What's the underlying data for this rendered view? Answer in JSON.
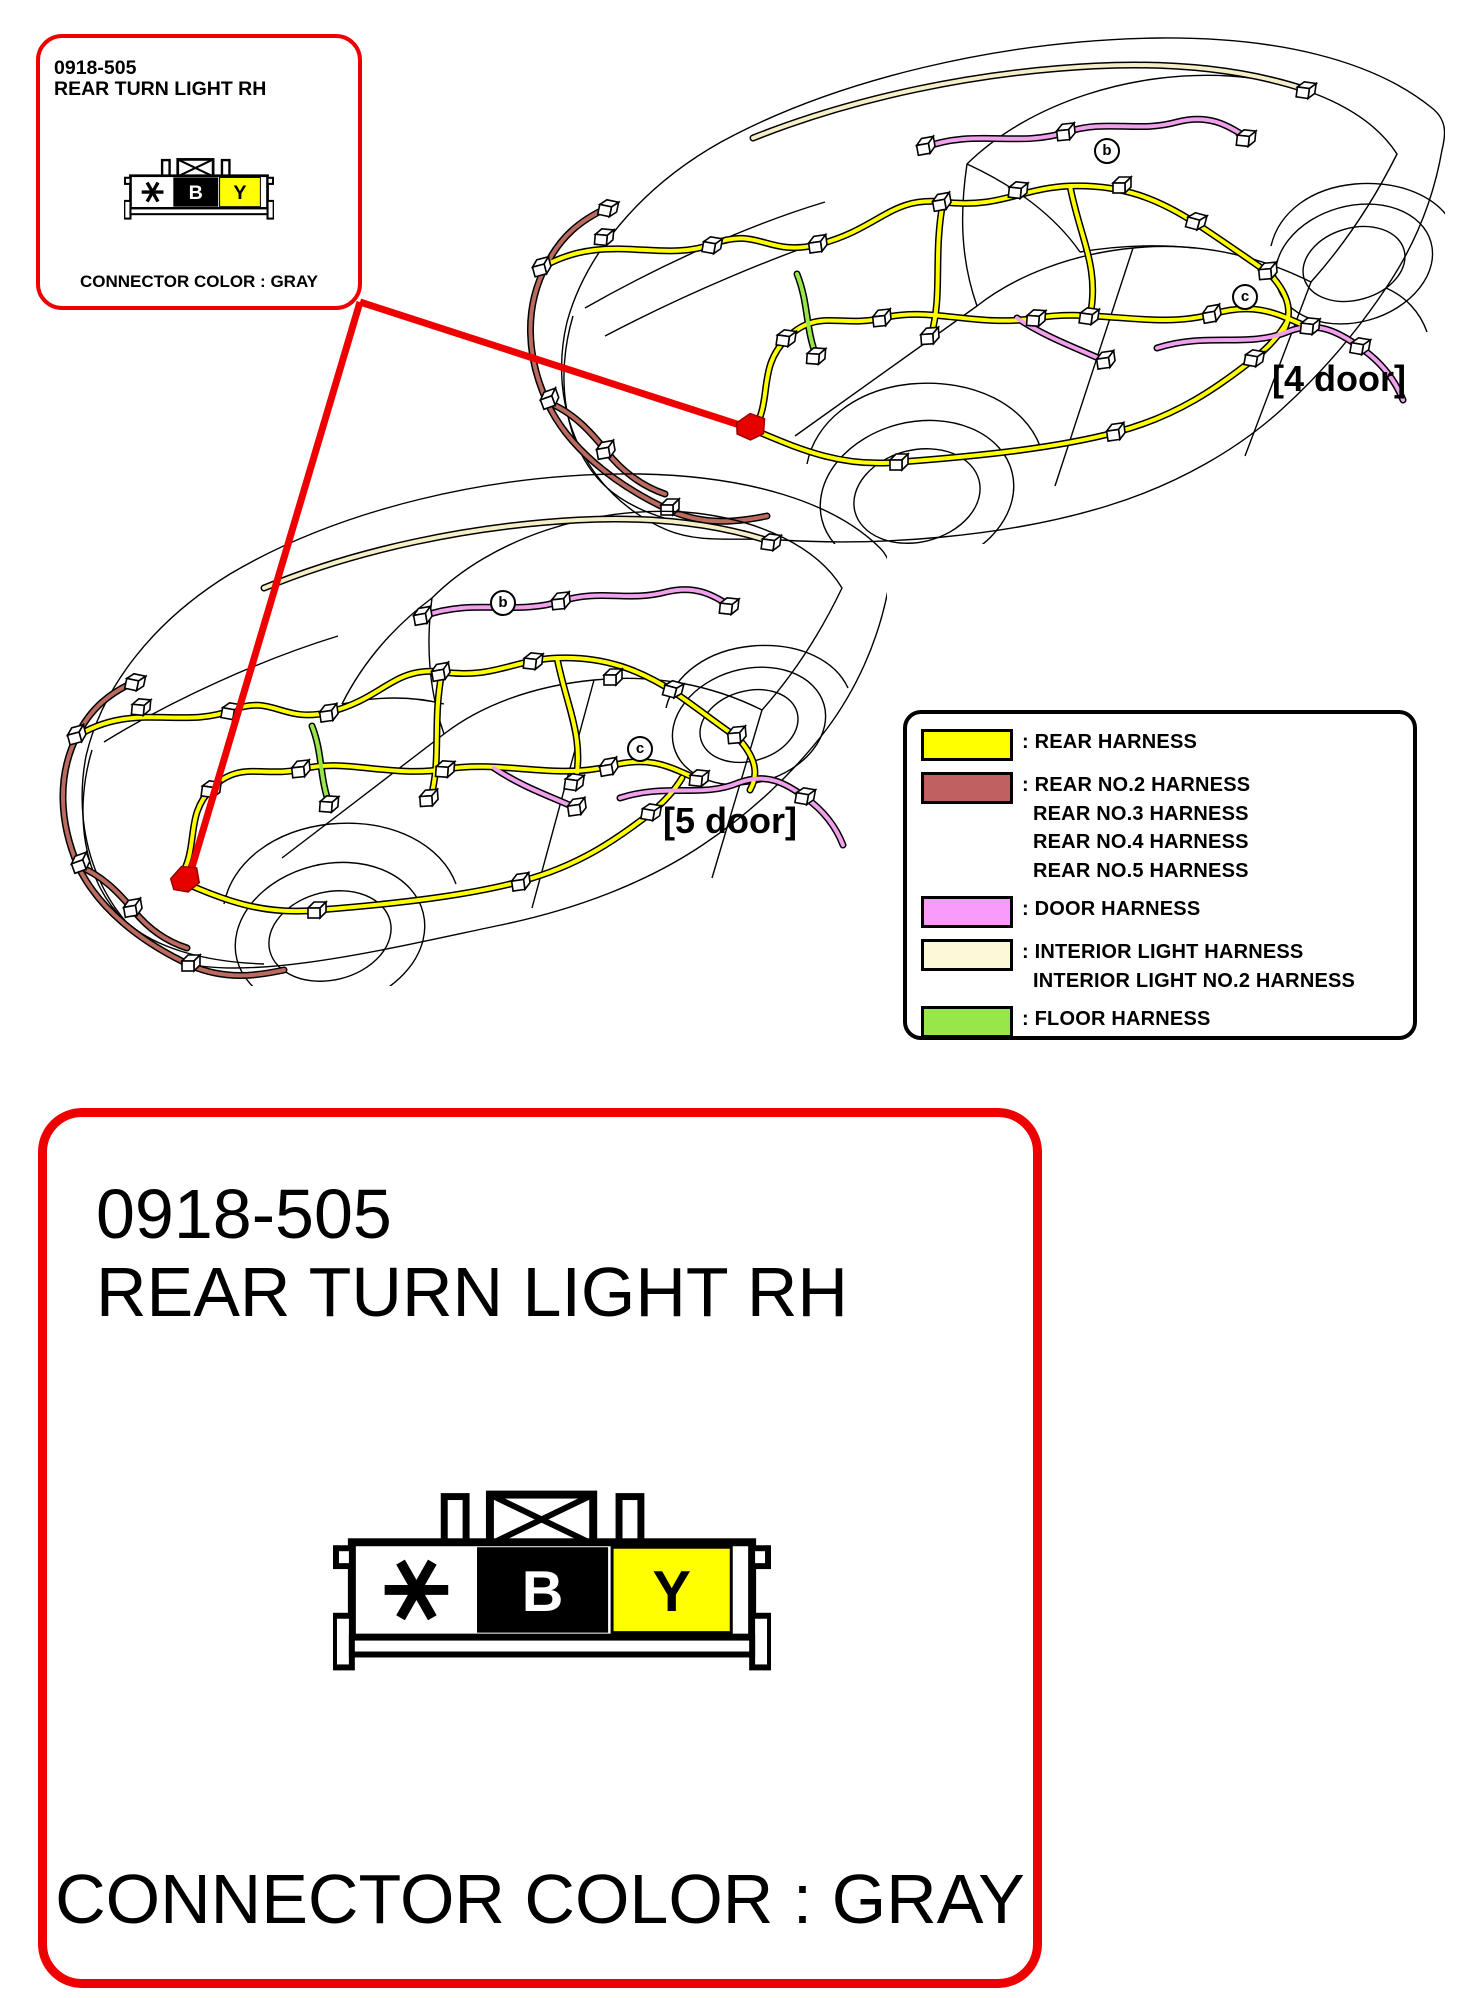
{
  "callout_box": {
    "part_number": "0918-505",
    "part_name": "REAR TURN LIGHT RH",
    "connector_color_label": "CONNECTOR COLOR : GRAY"
  },
  "detail_box": {
    "part_number": "0918-505",
    "part_name": "REAR TURN LIGHT RH",
    "connector_color_label": "CONNECTOR COLOR : GRAY"
  },
  "connector": {
    "pins": [
      "*",
      "B",
      "Y"
    ],
    "pin_colors": [
      "#ffffff",
      "#000000",
      "#ffff00"
    ]
  },
  "vehicles": [
    {
      "label": "[4 door]",
      "markers": [
        "b",
        "c"
      ]
    },
    {
      "label": "[5 door]",
      "markers": [
        "b",
        "c"
      ]
    }
  ],
  "legend": {
    "entries": [
      {
        "color": "#ffff00",
        "lines": [
          ": REAR HARNESS"
        ]
      },
      {
        "color": "#c06060",
        "lines": [
          ": REAR NO.2 HARNESS",
          "REAR NO.3 HARNESS",
          "REAR NO.4 HARNESS",
          "REAR NO.5 HARNESS"
        ]
      },
      {
        "color": "#f99cf9",
        "lines": [
          ": DOOR HARNESS"
        ]
      },
      {
        "color": "#fcf9d8",
        "lines": [
          ": INTERIOR LIGHT HARNESS",
          "INTERIOR LIGHT NO.2 HARNESS"
        ]
      },
      {
        "color": "#98e649",
        "lines": [
          ": FLOOR HARNESS"
        ]
      }
    ]
  },
  "colors": {
    "accent_red": "#ee0000",
    "rear_harness": "#ffff00",
    "rear_no2_harness": "#bb6a60",
    "door_harness": "#f0a0ec",
    "interior_light_harness": "#f5efc8",
    "floor_harness": "#98e649",
    "car_line": "#000000"
  }
}
